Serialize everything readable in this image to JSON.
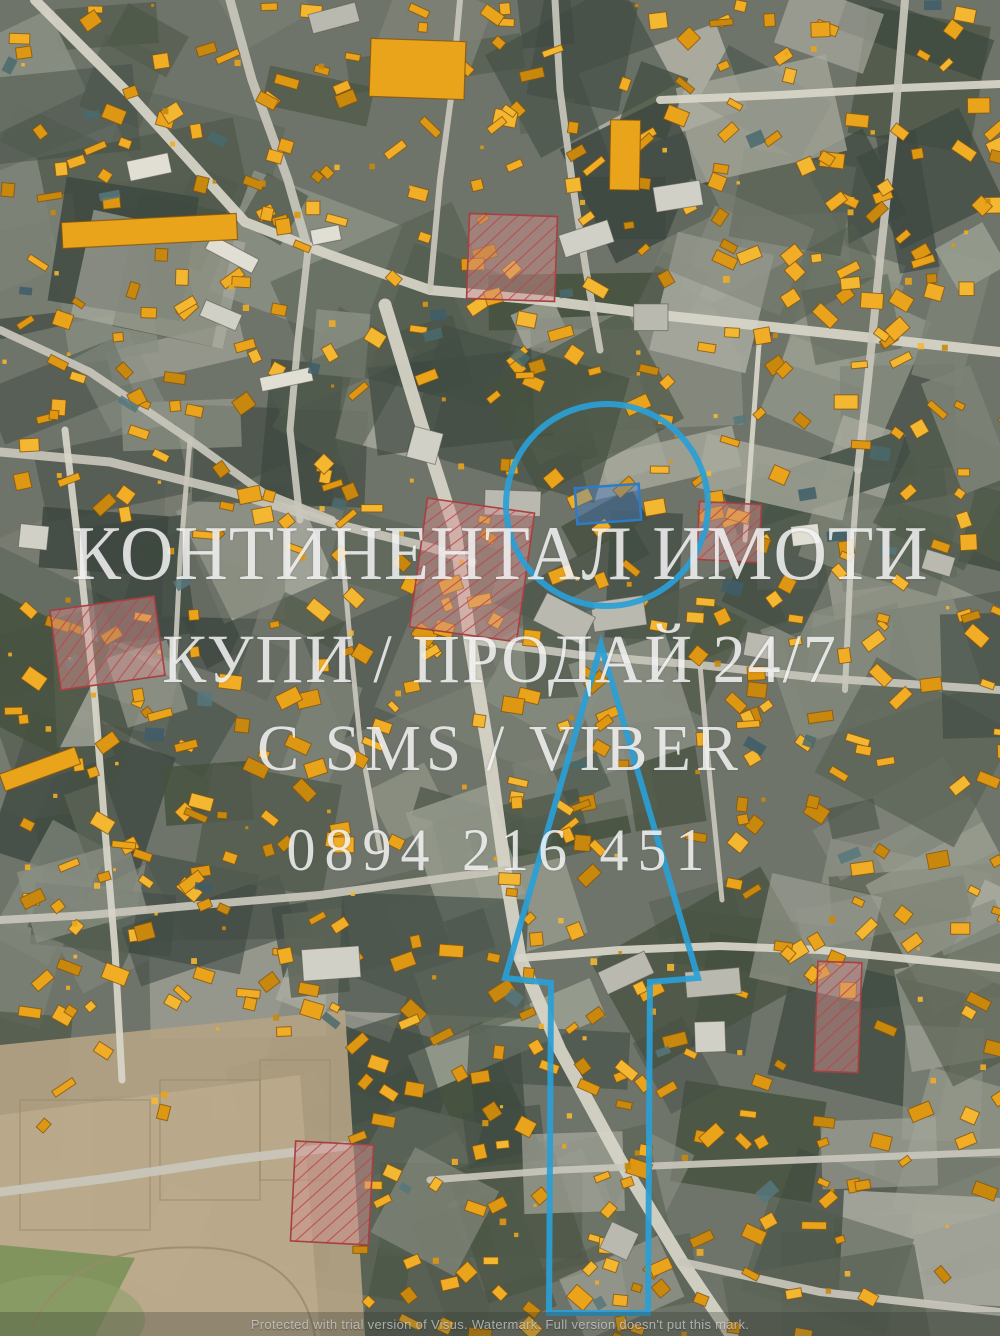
{
  "overlay": {
    "title": "КОНТИНЕНТАЛ ИМОТИ",
    "subtitle": "КУПИ / ПРОДАЙ 24/7",
    "contact": "С SMS / VIBER",
    "phone": "0894 216 451"
  },
  "watermark": {
    "text": "Protected with trial version of Visus. Watermark. Full version doesn't put this mark."
  },
  "annotations": {
    "circle_label": "highlighted-location-circle",
    "arrow_label": "direction-arrow",
    "accent_color": "#2aa0d6",
    "parcel_fill": "rgba(65,125,210,0.38)",
    "parcel_stroke": "#2d7cc8"
  },
  "map_style": {
    "base": "#6f746a",
    "terrain_darks": [
      "#46513f",
      "#3d4840",
      "#525c4e",
      "#5b6457",
      "#424d44"
    ],
    "terrain_lights": [
      "#999e90",
      "#8a8f83",
      "#a8aa9e",
      "#7d8276",
      "#b2b2a6"
    ],
    "field_color": "#b3a284",
    "field_line": "#998a6c",
    "grass_color": "#7d925c",
    "road_color": "#c9c7bb",
    "road_bright": "#d8d6c9",
    "building_fills": [
      "#e9a41c",
      "#f0ad25",
      "#dd9712",
      "#f4b732",
      "#c8880e"
    ],
    "building_outline": "rgba(130,80,10,0.75)",
    "big_building_fills": [
      "#d0d0c6",
      "#e1dfd4",
      "#b9b9af"
    ],
    "roof_teals": [
      "#4a6a6c",
      "#3f5d68",
      "#56777c"
    ],
    "restricted_fill": "#d49090",
    "restricted_hatch": "#b84848",
    "restricted_border": "#a84040"
  }
}
